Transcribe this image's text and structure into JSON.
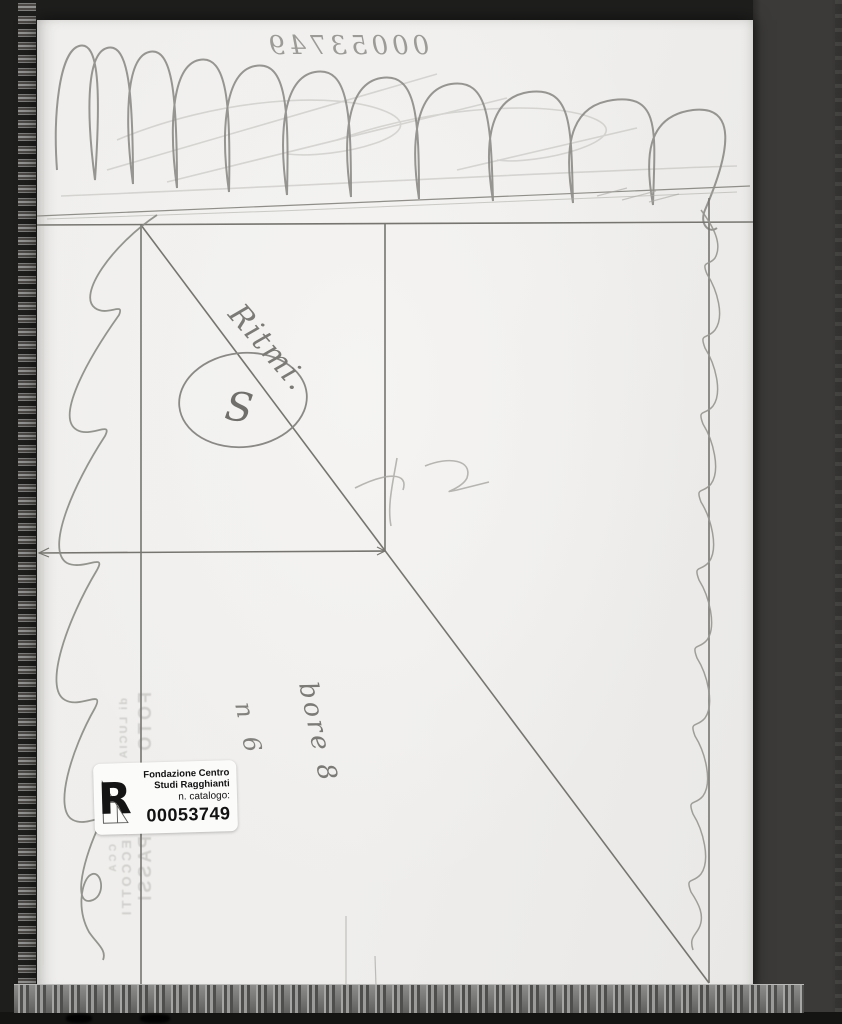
{
  "photo": {
    "handwritten_number_mirrored": "00053749",
    "annotations": {
      "diagonal_word": "Ritmi.",
      "circled_letter": "S",
      "vertical_note_1": "bore 8",
      "vertical_note_2": "n 6"
    },
    "stamp_watermark": {
      "line1": "FOTO",
      "line2": "di LUCIA",
      "line3": "PASSI",
      "line4": "ECCOTTI",
      "line5": "CCA"
    },
    "label": {
      "logo_letter": "R",
      "org_line1": "Fondazione Centro",
      "org_line2": "Studi Ragghianti",
      "catalog_caption": "n. catalogo:",
      "catalog_number": "00053749"
    },
    "colors": {
      "sleeve_dark": "#1e1e1d",
      "sleeve_right": "#3b3a38",
      "paper": "#f0efed",
      "pencil": "#84837f",
      "stamp_gray": "#b5b4b1",
      "label_bg": "#fbfbfa",
      "label_text": "#121212"
    }
  }
}
